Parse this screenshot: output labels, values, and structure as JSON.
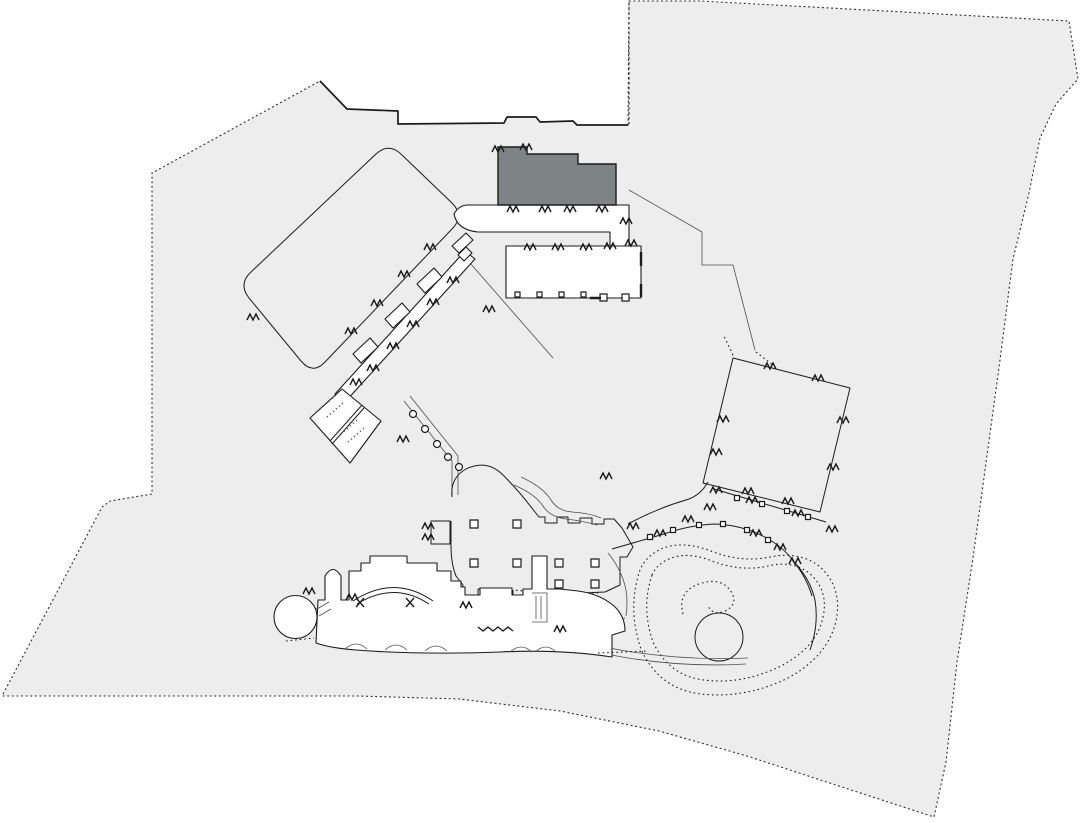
{
  "canvas": {
    "width": 1080,
    "height": 823,
    "background": "#ffffff"
  },
  "palette": {
    "site_fill": "#ededed",
    "building_fill": "#ffffff",
    "tower_fill": "#7e8486",
    "outline": "#1c1c1c",
    "boundary": "#2f2f2f",
    "detail": "#4d4d4d"
  },
  "features": {
    "site_boundary": {
      "d": "M320 81 L347 109 L398 111 L398 124 L504 123 L507 117 L536 117 L540 122 L573 121 L577 125 L628 125 L629 1 L700 1 L1069 21 L1078 79 L1056 104 L1040 138 L1029 193 L1013 259 L1000 360 L989 441 L973 558 L957 662 L946 762 L934 817 L747 756 L659 731 L560 711 L459 699 L358 696 L2 696 L102 507 L110 501 L152 494 L152 173 Z"
    },
    "parcel_edge": {
      "d": "M320 81 L347 109 L398 111 L398 124 L504 123 L507 117 L536 117 L540 122 L573 121 L577 125 L628 125"
    },
    "parcel_dash": {
      "d": "M629 2 L629 124"
    },
    "courtyard": {
      "d": "M376 154 Q389 142 402 155 L452 203 Q465 216 452 229 L325 362 Q313 375 301 361 L249 298 Q238 284 251 272 Z"
    },
    "court_wing": {
      "d": "M335 394 L465 251 L475 259 L345 402 Z"
    },
    "wing_rooms": {
      "d": "M417 284 l17 -16 l8 9 l-17 16 Z M385 319 l17 -16 l8 9 l-17 16 Z M353 354 l17 -16 l8 9 l-17 16 Z"
    },
    "junction_blocks": {
      "d": "M452 246 L466 233 L473 240 L459 253 Z M458 255 L466 247 L472 253 L464 261 Z"
    },
    "spa": {
      "d": "M342 389 L381 421 L350 463 L310 418 Z"
    },
    "spa_divider": {
      "d": "M362 405 L330 441 M364 408 L332 444"
    },
    "spa_dots": {
      "d": "M320 409 l16 -14 M327 417 l16 -14 M341 434 l16 -14 M348 442 l16 -14"
    },
    "corridor_g": {
      "d": "M404 401 L452 461 L452 497 M410 396 L458 456 L458 495"
    },
    "corridor_g_circles": {
      "d": "M409.5 414 a3.5 3.5 0 1 0 7 0 a3.5 3.5 0 1 0 -7 0 M421.5 429 a3.5 3.5 0 1 0 7 0 a3.5 3.5 0 1 0 -7 0 M433.5 444 a3.5 3.5 0 1 0 7 0 a3.5 3.5 0 1 0 -7 0 M444.5 457 a3.5 3.5 0 1 0 7 0 a3.5 3.5 0 1 0 -7 0 M455.5 467 a3.5 3.5 0 1 0 7 0 a3.5 3.5 0 1 0 -7 0"
    },
    "band": {
      "d": "M468 205 L629 205 L629 247 L610 247 L610 232 L478 232 Q457 230 454 214 Q459 205 468 205 Z"
    },
    "tower_dark": {
      "d": "M498 147 L527 147 L527 154 L578 154 L578 164 L616 164 L616 205 L498 205 Z"
    },
    "hotel_block": {
      "d": "M506 246 L641 246 L641 298 L506 298 Z"
    },
    "hotel_columns": {
      "d": "M515 292 h5 v5 h-5 Z M537 292 h5 v5 h-5 Z M559 292 h5 v5 h-5 Z M581 292 h5 v5 h-5 Z M600 294 h7 v7 h-7 Z M622 294 h7 v7 h-7 Z"
    },
    "hotel_edge_marks": {
      "d": "M641 252 L641 266 M641 284 L641 297 M590 298 L601 298"
    },
    "road_east": {
      "d": "M629 190 L702 232 L702 265 L733 265 L755 350"
    },
    "road_east_dots": {
      "d": "M756 352 L774 366 M733 355 L724 336"
    },
    "road_sw": {
      "d": "M470 263 L553 358"
    },
    "lobby_solid": {
      "d": "M452 497 Q450 478 466 469 Q487 459 503 475 Q519 491 531 507 L539 517 L545 517 L545 523 L557 523 L557 517 L568 517 L568 523 L580 523 L580 518 L592 518 L592 524 L604 524 L604 519 L614 519 L622 528 M622 528 L633 547 L627 557 L620 557 L620 585 L605 592 L560 594 L560 601 L545 601 L545 593 M513 590 L513 598 L498 598 L498 588 M478 589 L478 597 L463 597 L463 585 L456 576 Q451 564 451 545 L451 521"
    },
    "lobby_square": {
      "d": "M431 521 L450 521 L450 544 L431 544 Z"
    },
    "lobby_dotted": {
      "d": "M545 593 L513 590 M498 588 L478 589 M560 593 L598 593"
    },
    "lobby_columns": {
      "d": "M470 520 h8 v8 h-8 Z M513 520 h8 v8 h-8 Z M470 559 h8 v8 h-8 Z M513 559 h8 v8 h-8 Z M555 559 h8 v8 h-8 Z M591 559 h8 v8 h-8 Z M555 580 h8 v8 h-8 Z M591 580 h8 v8 h-8 Z"
    },
    "walkway_n": {
      "d": "M521 477 Q543 487 551 500 Q558 511 572 512 Q589 513 601 518 M514 485 Q535 494 543 506 Q550 517 566 519 Q583 521 597 525"
    },
    "colonnade_upper": {
      "d": "M628 524 Q658 508 686 500 Q700 496 708 482 M714 489 L826 522"
    },
    "colonnade_lower": {
      "d": "M612 549 Q640 541 664 534 Q690 525 715 524 Q745 525 770 540 Q786 550 793 561 Q806 576 812 596"
    },
    "colonnade_cols": {
      "d": "M734.5 495.5 h5 v5 h-5 Z M759.5 501.5 h5 v5 h-5 Z M784.5 508.5 h5 v5 h-5 Z M805.5 514.5 h5 v5 h-5 Z M647.5 534.5 h5 v5 h-5 Z M670.5 527.5 h5 v5 h-5 Z M696.5 522.5 h5 v5 h-5 Z M720.5 521.5 h5 v5 h-5 Z M744.5 527.5 h5 v5 h-5 Z M765.5 537.5 h5 v5 h-5 Z"
    },
    "facade_inner": {
      "d": "M608 553 Q622 570 626 590 Q628 603 626 616"
    },
    "pool_enclosure": {
      "d": "M793 561 Q810 578 815 600 Q819 625 810 650"
    },
    "pool_outer": {
      "d": "M640 570 Q627 608 641 649 Q659 689 701 694 Q745 699 788 678 Q828 656 836 621 Q843 587 819 566 Q799 551 770 557 Q741 563 711 551 Q682 540 661 549 Q646 556 640 570 Z"
    },
    "pool_inner": {
      "d": "M652 575 Q641 608 653 642 Q669 676 704 680 Q742 685 781 666 Q817 647 823 617 Q829 590 809 573 Q792 560 768 566 Q741 572 712 561 Q687 551 669 559 Q657 564 652 575 Z"
    },
    "pool_spiral": {
      "d": "M683 614 Q677 592 699 584 Q722 576 732 593 Q738 605 725 611 Q713 616 708 606"
    },
    "pool_island": {
      "d": "M695 637 a24 24 0 1 0 48 0 a24 24 0 1 0 -48 0"
    },
    "pool_bridge": {
      "d": "M573 640 Q660 662 748 658 M576 647 Q660 669 746 664"
    },
    "bridge_link": {
      "d": "M585 633 Q606 626 625 618"
    },
    "south_wing": {
      "d": "M318 600 L325 600 L325 576 Q333 563 341 576 L341 600 L349 600 L349 571 L361 571 L361 563 L370 563 L370 556 L407 556 L407 563 L437 563 L437 571 L451 571 L451 581 L461 581 L461 587 L465 587 L465 595 L480 595 L480 588 L512 588 L512 595 L523 595 L523 589 L532 589 L532 556 L547 556 L547 589 L560 589 L578 591 Q600 594 614 606 Q625 616 625 631 L612 635 L612 657 Q560 649 500 652 Q420 655 356 650 Q330 648 316 643 Z"
    },
    "hall_arcs": {
      "d": "M353 601 Q394 574 433 601 M357 604 Q394 581 429 604"
    },
    "hall_bowties": {
      "d": "M356 598 l8 9 m0 -9 l-8 9 M406 598 l8 9 m0 -9 l-8 9"
    },
    "stair_inner": {
      "d": "M532 593 L547 593 L547 622 L532 622 M536 596 L536 619 M541 596 L541 619"
    },
    "band_scallops": {
      "d": "M345 649 Q356 639 367 649 M385 650 Q396 640 407 650 M425 651 Q436 641 447 651 M510 652 Q521 642 532 652 M535 652 Q546 642 556 652"
    },
    "band_dotted": {
      "d": "M286 641 L314 638 M598 653 L648 651 M316 608 L316 625"
    },
    "zigzag_run": {
      "d": "M478 627 l5 4 l5 -4 l5 4 l5 -4 l5 4 l5 -4 l5 4"
    },
    "rotunda": {
      "d": "M274 617 a21.5 21.5 0 1 0 43 0 a21.5 21.5 0 1 0 -43 0"
    },
    "rotunda_link": {
      "d": "M317 609 L329 602 M319 616 L331 609"
    },
    "square_hall": {
      "d": "M733 358 L850 388 L820 512 L703 483 Z"
    },
    "notch_ticks": {
      "d": "M424 250 l3 -6 l3 6 l3 -6 l3 6 M398 277 l3 -6 l3 6 l3 -6 l3 6 M371 306 l3 -6 l3 6 l3 -6 l3 6 M345 334 l3 -6 l3 6 l3 -6 l3 6 M247 320 l3 -6 l3 6 l3 -6 l3 6 M492 152 l3 -6 l3 6 l3 -6 l3 6 M520 150 l3 -6 l3 6 l3 -6 l3 6 M507 212 l3 -6 l3 6 l3 -6 l3 6 M539 212 l3 -6 l3 6 l3 -6 l3 6 M564 212 l3 -6 l3 6 l3 -6 l3 6 M596 212 l3 -6 l3 6 l3 -6 l3 6 M620 224 l3 -6 l3 6 l3 -6 l3 6 M524 250 l3 -6 l3 6 l3 -6 l3 6 M552 250 l3 -6 l3 6 l3 -6 l3 6 M580 250 l3 -6 l3 6 l3 -6 l3 6 M604 249 l3 -6 l3 6 l3 -6 l3 6 M625 246 l3 -6 l3 6 l3 -6 l3 6 M447 283 l3 -6 l3 6 l3 -6 l3 6 M427 305 l3 -6 l3 6 l3 -6 l3 6 M407 327 l3 -6 l3 6 l3 -6 l3 6 M387 349 l3 -6 l3 6 l3 -6 l3 6 M367 371 l3 -6 l3 6 l3 -6 l3 6 M350 385 l3 -6 l3 6 l3 -6 l3 6 M397 442 l3 -6 l3 6 l3 -6 l3 6 M764 369 l3 -6 l3 6 l3 -6 l3 6 M812 381 l3 -6 l3 6 l3 -6 l3 6 M837 423 l3 -6 l3 6 l3 -6 l3 6 M827 470 l3 -6 l3 6 l3 -6 l3 6 M782 504 l3 -6 l3 6 l3 -6 l3 6 M742 494 l3 -6 l3 6 l3 -6 l3 6 M717 422 l3 -6 l3 6 l3 -6 l3 6 M710 455 l3 -6 l3 6 l3 -6 l3 6 M627 529 l3 -6 l3 6 l3 -6 l3 6 M654 536 l3 -6 l3 6 l3 -6 l3 6 M682 522 l3 -6 l3 6 l3 -6 l3 6 M704 510 l3 -6 l3 6 l3 -6 l3 6 M750 536 l3 -6 l3 6 l3 -6 l3 6 M774 550 l3 -6 l3 6 l3 -6 l3 6 M789 564 l3 -6 l3 6 l3 -6 l3 6 M826 532 l3 -6 l3 6 l3 -6 l3 6 M710 493 l3 -6 l3 6 l3 -6 l3 6 M746 503 l3 -6 l3 6 l3 -6 l3 6 M792 516 l3 -6 l3 6 l3 -6 l3 6 M422 529 l3 -6 l3 6 l3 -6 l3 6 M422 540 l3 -6 l3 6 l3 -6 l3 6 M346 600 l3 -6 l3 6 l3 -6 l3 6 M460 608 l3 -6 l3 6 l3 -6 l3 6 M554 632 l3 -6 l3 6 l3 -6 l3 6 M303 594 l3 -6 l3 6 l3 -6 l3 6 M483 312 l3 -6 l3 6 l3 -6 l3 6 M600 479 l3 -6 l3 6 l3 -6 l3 6"
    }
  }
}
